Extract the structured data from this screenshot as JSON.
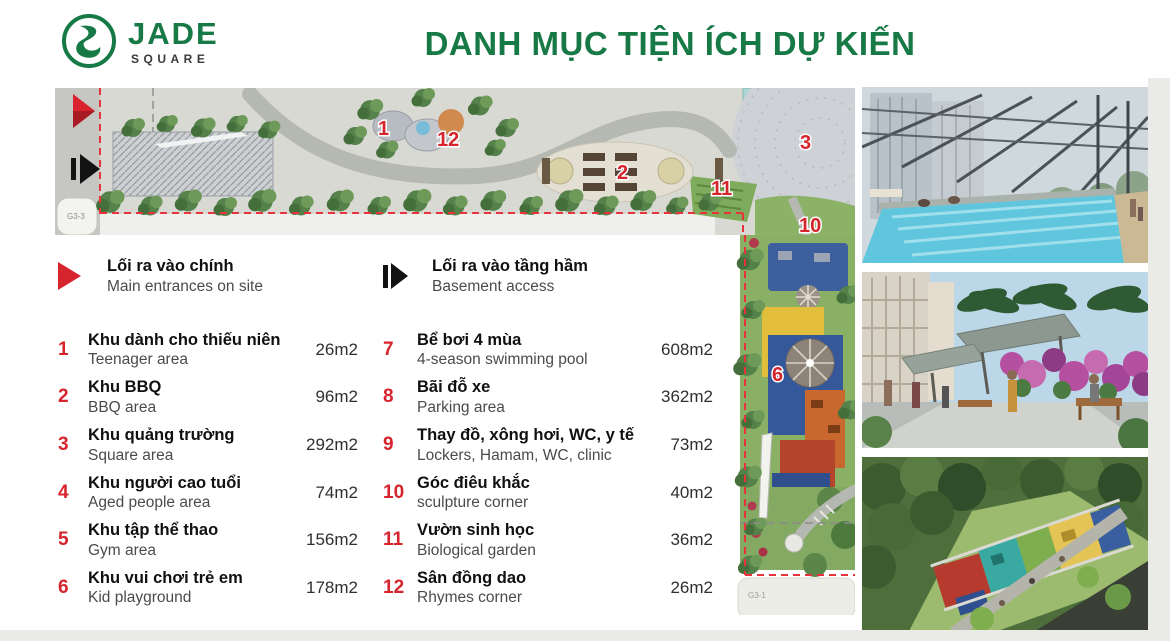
{
  "header": {
    "logo": {
      "brand": "JADE",
      "sub": "SQUARE"
    },
    "title": "DANH MỤC TIỆN ÍCH DỰ KIẾN"
  },
  "colors": {
    "brand_green": "#177a46",
    "accent_red": "#d6242d"
  },
  "entrances": [
    {
      "icon": "main-entrance-icon",
      "vi": "Lối ra vào chính",
      "en": "Main entrances on site"
    },
    {
      "icon": "basement-access-icon",
      "vi": "Lối ra vào tầng hầm",
      "en": "Basement access"
    }
  ],
  "amenities_left": [
    {
      "no": "1",
      "vi": "Khu dành cho thiếu niên",
      "en": "Teenager area",
      "area": "26m2"
    },
    {
      "no": "2",
      "vi": "Khu BBQ",
      "en": "BBQ area",
      "area": "96m2"
    },
    {
      "no": "3",
      "vi": "Khu quảng trường",
      "en": "Square area",
      "area": "292m2"
    },
    {
      "no": "4",
      "vi": "Khu người cao tuổi",
      "en": "Aged people area",
      "area": "74m2"
    },
    {
      "no": "5",
      "vi": "Khu tập thể thao",
      "en": "Gym area",
      "area": "156m2"
    },
    {
      "no": "6",
      "vi": "Khu vui chơi trẻ em",
      "en": "Kid playground",
      "area": "178m2"
    }
  ],
  "amenities_right": [
    {
      "no": "7",
      "vi": "Bể bơi 4 mùa",
      "en": "4-season swimming pool",
      "area": "608m2"
    },
    {
      "no": "8",
      "vi": "Bãi đỗ xe",
      "en": "Parking area",
      "area": "362m2"
    },
    {
      "no": "9",
      "vi": "Thay đồ, xông hơi, WC, y tế",
      "en": "Lockers, Hamam, WC, clinic",
      "area": "73m2"
    },
    {
      "no": "10",
      "vi": "Góc điêu khắc",
      "en": "sculpture corner",
      "area": "40m2"
    },
    {
      "no": "11",
      "vi": "Vườn sinh học",
      "en": "Biological garden",
      "area": "36m2"
    },
    {
      "no": "12",
      "vi": "Sân đồng dao",
      "en": "Rhymes corner",
      "area": "26m2"
    }
  ],
  "siteplan": {
    "markers": [
      "1",
      "12",
      "2",
      "3",
      "11",
      "10",
      "6"
    ],
    "plot_labels": {
      "left": "G3-3",
      "bottom": "G3-1"
    }
  }
}
